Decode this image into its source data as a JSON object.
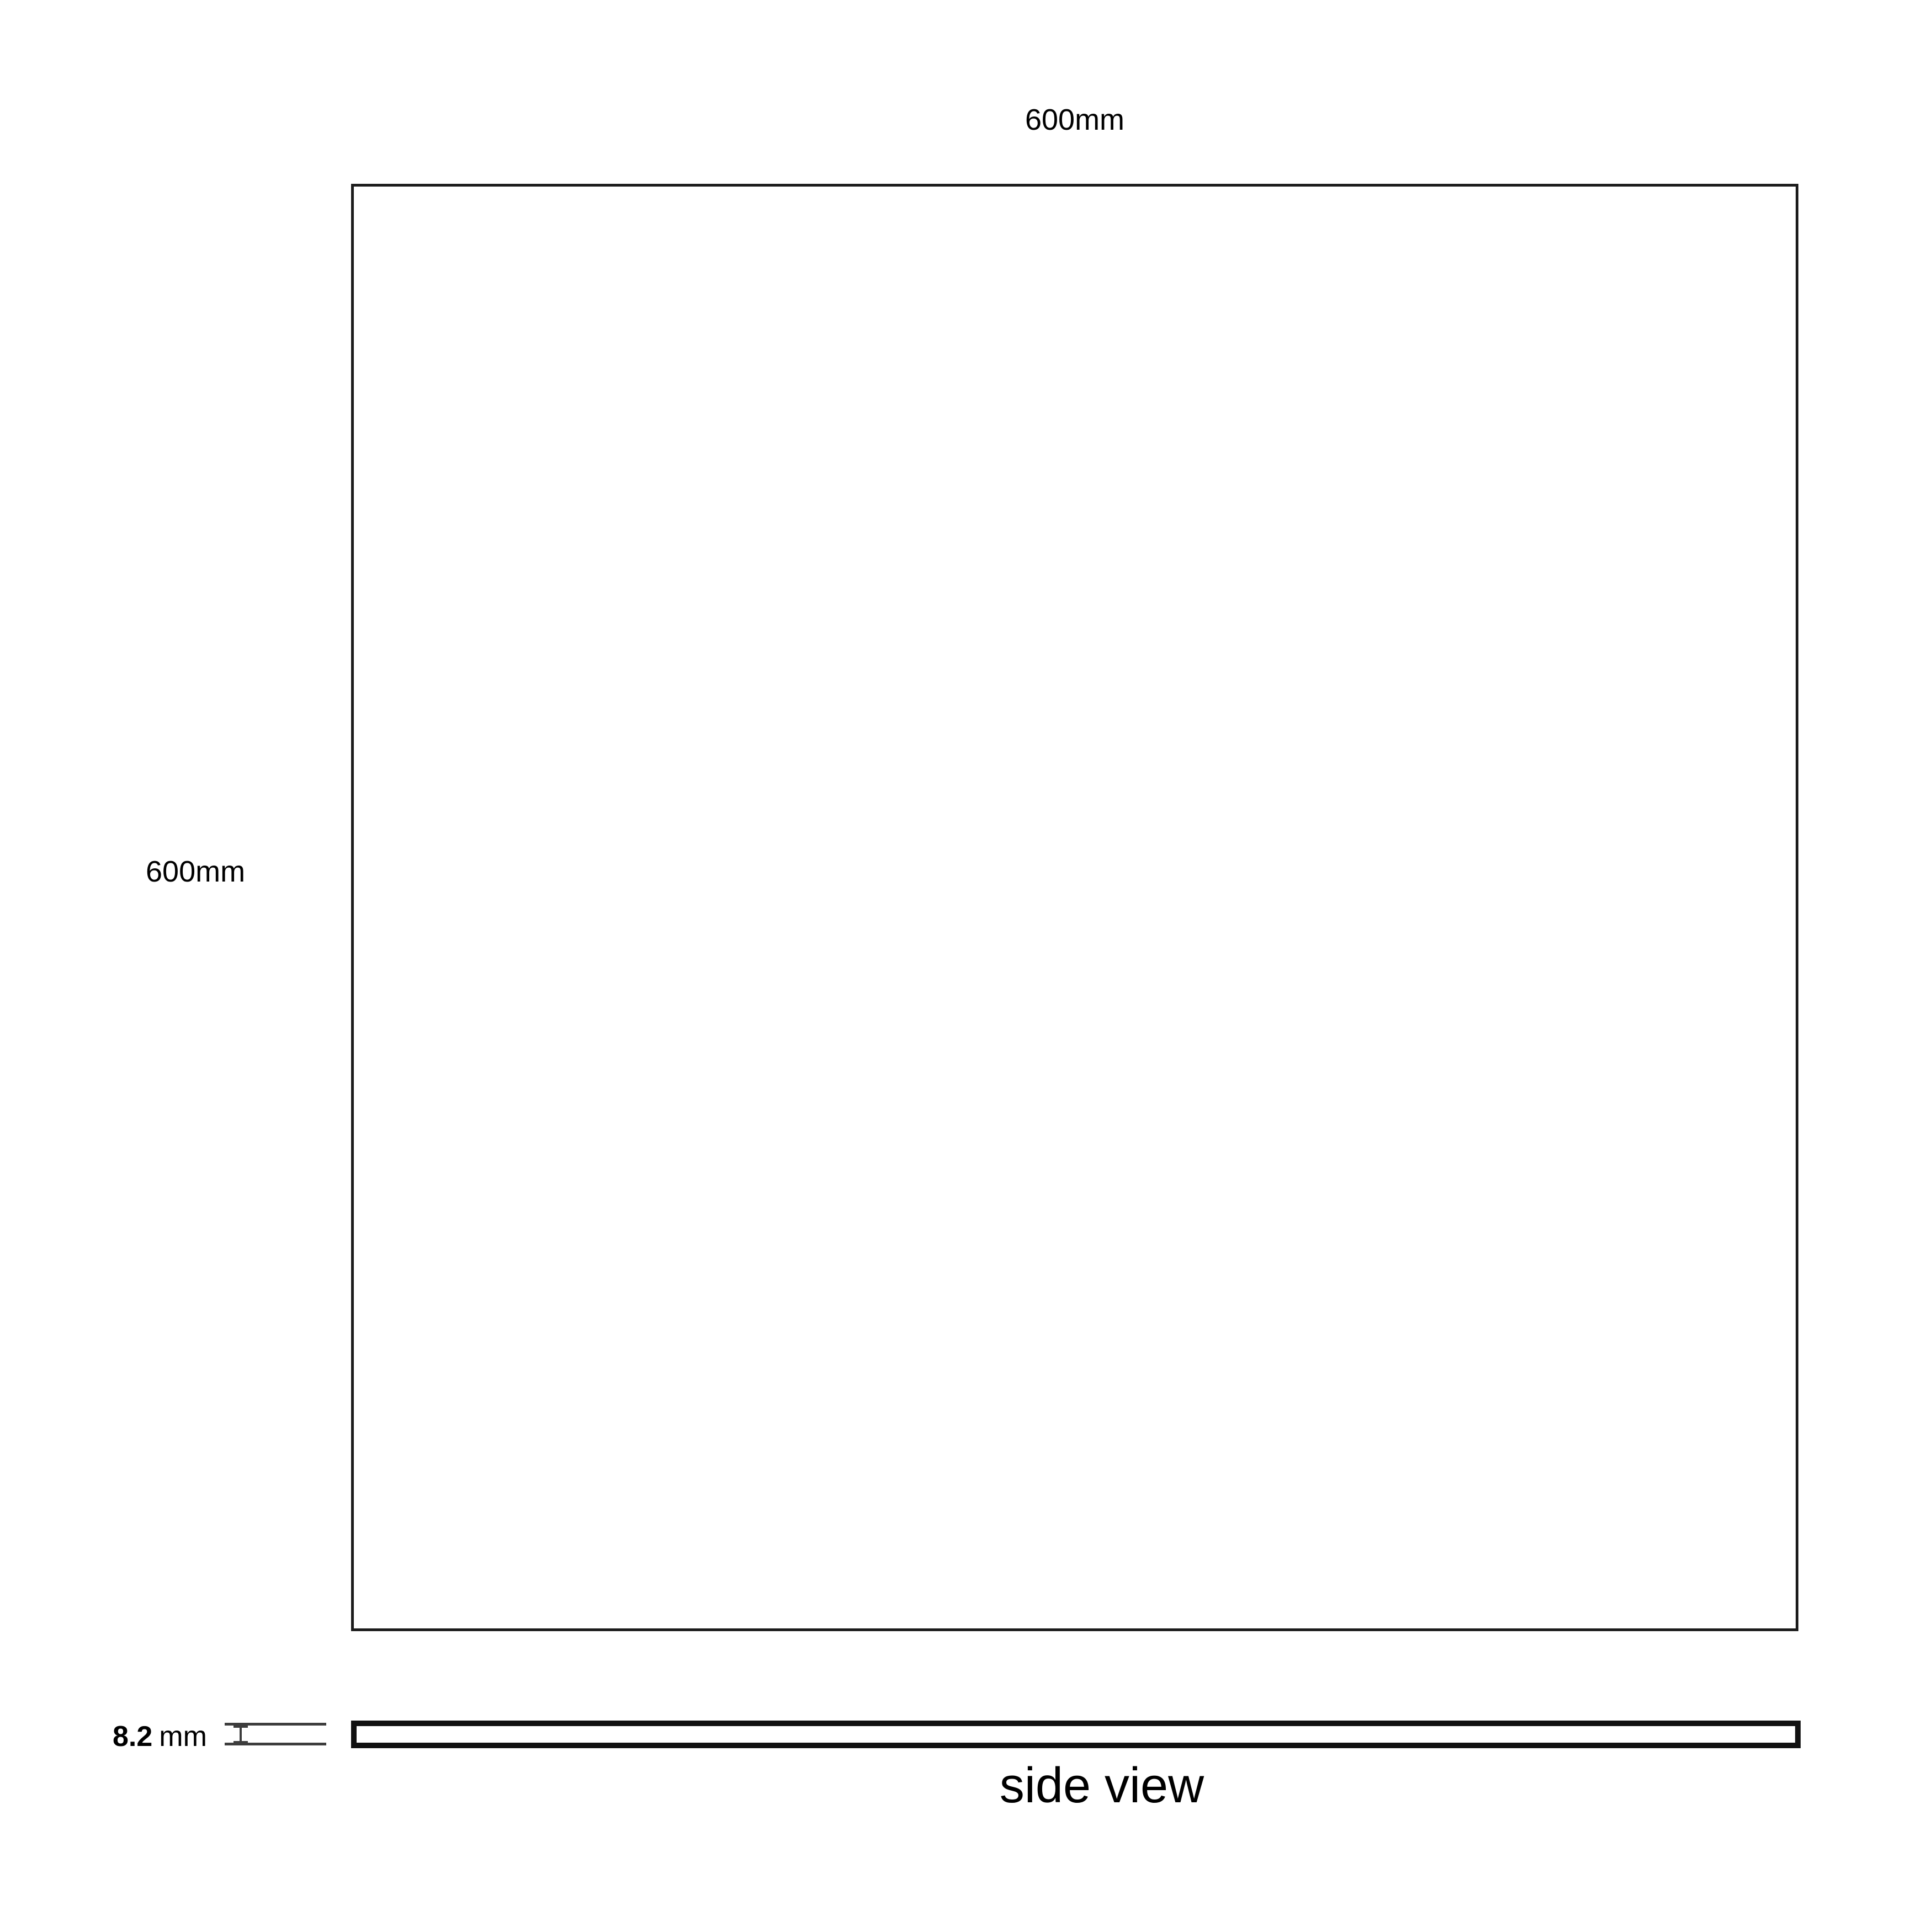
{
  "diagram": {
    "top_view": {
      "width_label": "600mm",
      "height_label": "600mm"
    },
    "side_view": {
      "thickness_value": "8.2",
      "thickness_unit": "mm",
      "caption": "side view"
    },
    "colors": {
      "square_outline": "#1c1c1c",
      "bar_outline": "#111111",
      "dimension_marker": "#3d3d3d",
      "text": "#000000",
      "background": "#ffffff"
    }
  }
}
